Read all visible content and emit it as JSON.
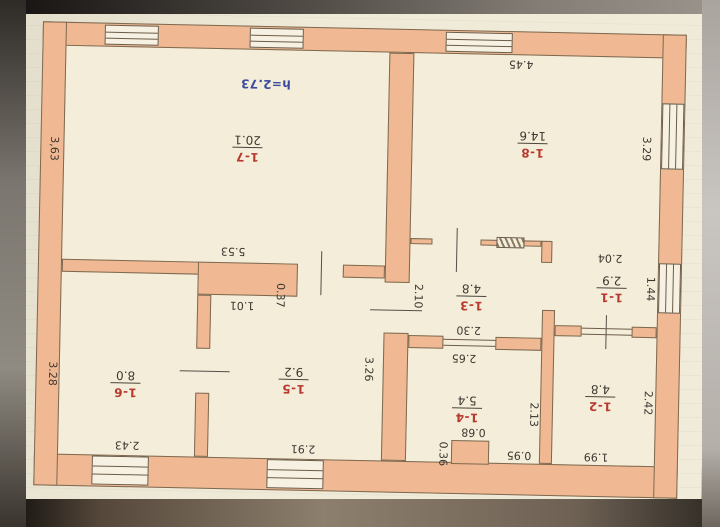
{
  "plan": {
    "height_note": "h=2.73",
    "rooms": {
      "r1": {
        "number": "1-1",
        "area": "2.9"
      },
      "r2": {
        "number": "1-2",
        "area": "4.8"
      },
      "r3": {
        "number": "1-3",
        "area": "4.8"
      },
      "r4": {
        "number": "1-4",
        "area": "5.4"
      },
      "r5": {
        "number": "1-5",
        "area": "9.2"
      },
      "r6": {
        "number": "1-6",
        "area": "8.0"
      },
      "r7": {
        "number": "1-7",
        "area": "20.1"
      },
      "r8": {
        "number": "1-8",
        "area": "14.6"
      }
    },
    "dimensions": {
      "d363": "3,63",
      "d553": "5.53",
      "d445": "4.45",
      "d329": "3.29",
      "d204": "2.04",
      "d144": "1.44",
      "d210": "2.10",
      "d230": "2.30",
      "d265": "2.65",
      "d213": "2.13",
      "d068": "0.68",
      "d036": "0.36",
      "d095": "0.95",
      "d199": "1.99",
      "d242": "2.42",
      "d291": "2.91",
      "d326": "3.26",
      "d243": "2.43",
      "d328": "3.28",
      "d101": "1.01",
      "d037": "0.37"
    },
    "colors": {
      "wall_fill": "#f0b893",
      "paper": "#efe9d7",
      "room_number_text": "#b83a2e",
      "dimension_text": "#3e3831",
      "height_note_text": "#3a4a9c",
      "ink_outline": "#6b5c49"
    },
    "orientation": "plan photographed upside down (all text rotated 180°)"
  }
}
